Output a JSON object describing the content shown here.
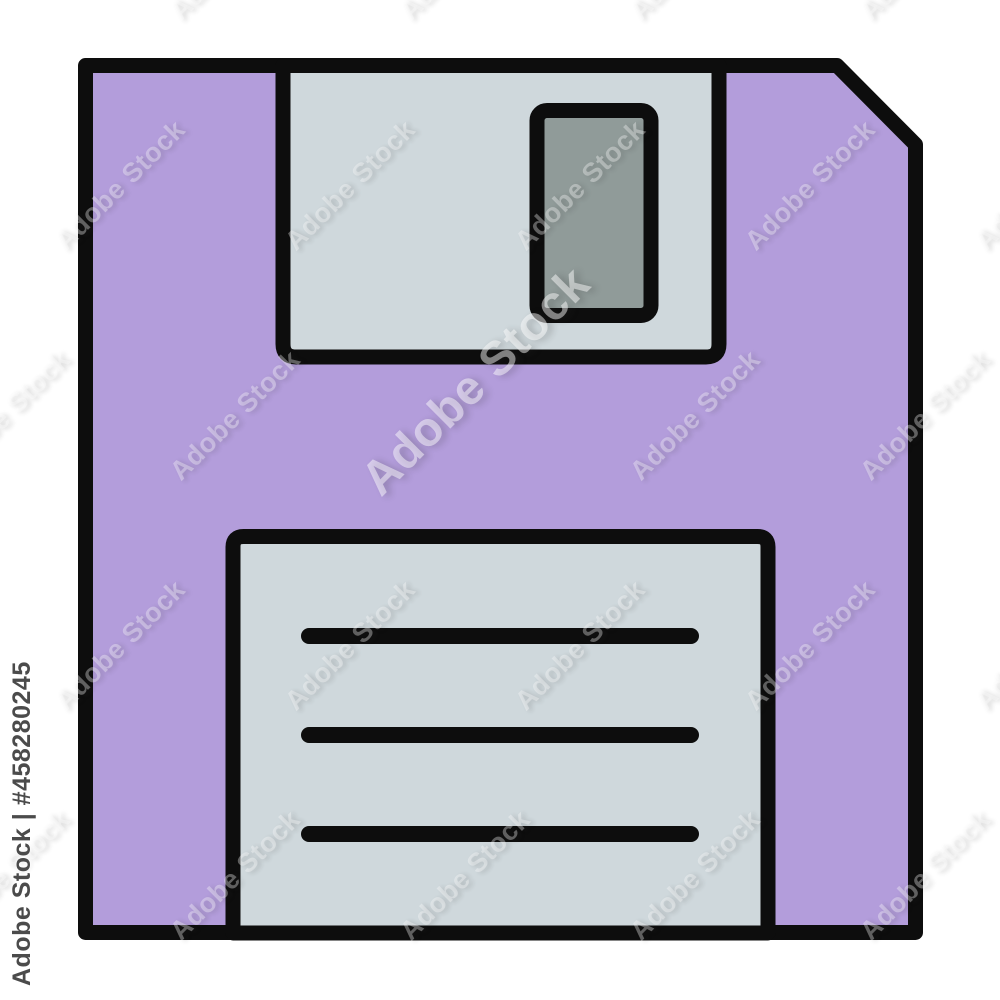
{
  "image": {
    "kind": "stock-icon-preview",
    "subject": "floppy-disk-save-icon"
  },
  "watermark": {
    "brand": "Adobe Stock",
    "id_text": "Adobe Stock | #458280245",
    "stock_number": "458280245"
  },
  "icon": {
    "name": "floppy-disk",
    "colors": {
      "body": "#b39ddb",
      "panel": "#cfd8dc",
      "window": "#909b99",
      "outline": "#0d0d0d",
      "background": "#ffffff"
    }
  }
}
